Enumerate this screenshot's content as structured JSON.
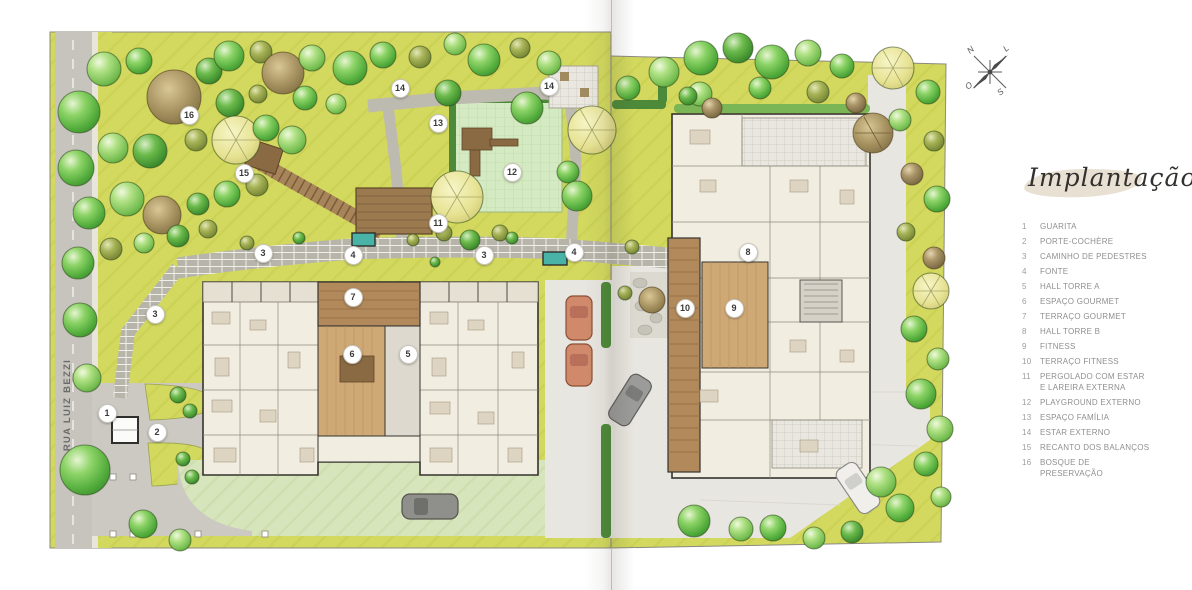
{
  "page": {
    "kind": "architectural site plan brochure spread"
  },
  "legend": {
    "title": "Implantação",
    "items": [
      {
        "num": "1",
        "label": "GUARITA"
      },
      {
        "num": "2",
        "label": "PORTE-COCHÈRE"
      },
      {
        "num": "3",
        "label": "CAMINHO DE PEDESTRES"
      },
      {
        "num": "4",
        "label": "FONTE"
      },
      {
        "num": "5",
        "label": "HALL TORRE A"
      },
      {
        "num": "6",
        "label": "ESPAÇO GOURMET"
      },
      {
        "num": "7",
        "label": "TERRAÇO GOURMET"
      },
      {
        "num": "8",
        "label": "HALL TORRE B"
      },
      {
        "num": "9",
        "label": "FITNESS"
      },
      {
        "num": "10",
        "label": "TERRAÇO FITNESS"
      },
      {
        "num": "11",
        "label": "PERGOLADO COM ESTAR E LAREIRA EXTERNA"
      },
      {
        "num": "12",
        "label": "PLAYGROUND EXTERNO"
      },
      {
        "num": "13",
        "label": "ESPAÇO FAMÍLIA"
      },
      {
        "num": "14",
        "label": "ESTAR EXTERNO"
      },
      {
        "num": "15",
        "label": "RECANTO DOS BALANÇOS"
      },
      {
        "num": "16",
        "label": "BOSQUE DE PRESERVAÇÃO"
      }
    ]
  },
  "street": {
    "name": "RUA LUIZ BEZZI"
  },
  "compass": {
    "north": "N",
    "south": "S",
    "east": "L",
    "west": "O"
  },
  "markers": [
    {
      "id": "plan-marker-16",
      "num": "16"
    },
    {
      "id": "plan-marker-15",
      "num": "15"
    },
    {
      "id": "plan-marker-14a",
      "num": "14"
    },
    {
      "id": "plan-marker-13",
      "num": "13"
    },
    {
      "id": "plan-marker-14b",
      "num": "14"
    },
    {
      "id": "plan-marker-12",
      "num": "12"
    },
    {
      "id": "plan-marker-11",
      "num": "11"
    },
    {
      "id": "plan-marker-3a",
      "num": "3"
    },
    {
      "id": "plan-marker-4a",
      "num": "4"
    },
    {
      "id": "plan-marker-3b",
      "num": "3"
    },
    {
      "id": "plan-marker-4b",
      "num": "4"
    },
    {
      "id": "plan-marker-3c",
      "num": "3"
    },
    {
      "id": "plan-marker-7",
      "num": "7"
    },
    {
      "id": "plan-marker-6",
      "num": "6"
    },
    {
      "id": "plan-marker-5",
      "num": "5"
    },
    {
      "id": "plan-marker-8",
      "num": "8"
    },
    {
      "id": "plan-marker-10",
      "num": "10"
    },
    {
      "id": "plan-marker-9",
      "num": "9"
    },
    {
      "id": "plan-marker-1",
      "num": "1"
    },
    {
      "id": "plan-marker-2",
      "num": "2"
    }
  ],
  "colors": {
    "lawn": "#d2d95e",
    "lawn_pale": "#d7e5bc",
    "plaza": "#e8e6e0",
    "road": "#c6c4bd",
    "path_brick": "#b7b4aa",
    "wood_deck": "#b2895a",
    "wood_floor": "#cfa975",
    "building": "#f1ede1",
    "wall": "#35332e",
    "hedge": "#4c8a39",
    "fountain": "#49b3a8",
    "tree_green": "#5cb544",
    "tree_olive": "#8a9a44",
    "tree_brown": "#96835a",
    "canopy_pale": "#e7e394",
    "legend_text": "#8f8f8f"
  }
}
